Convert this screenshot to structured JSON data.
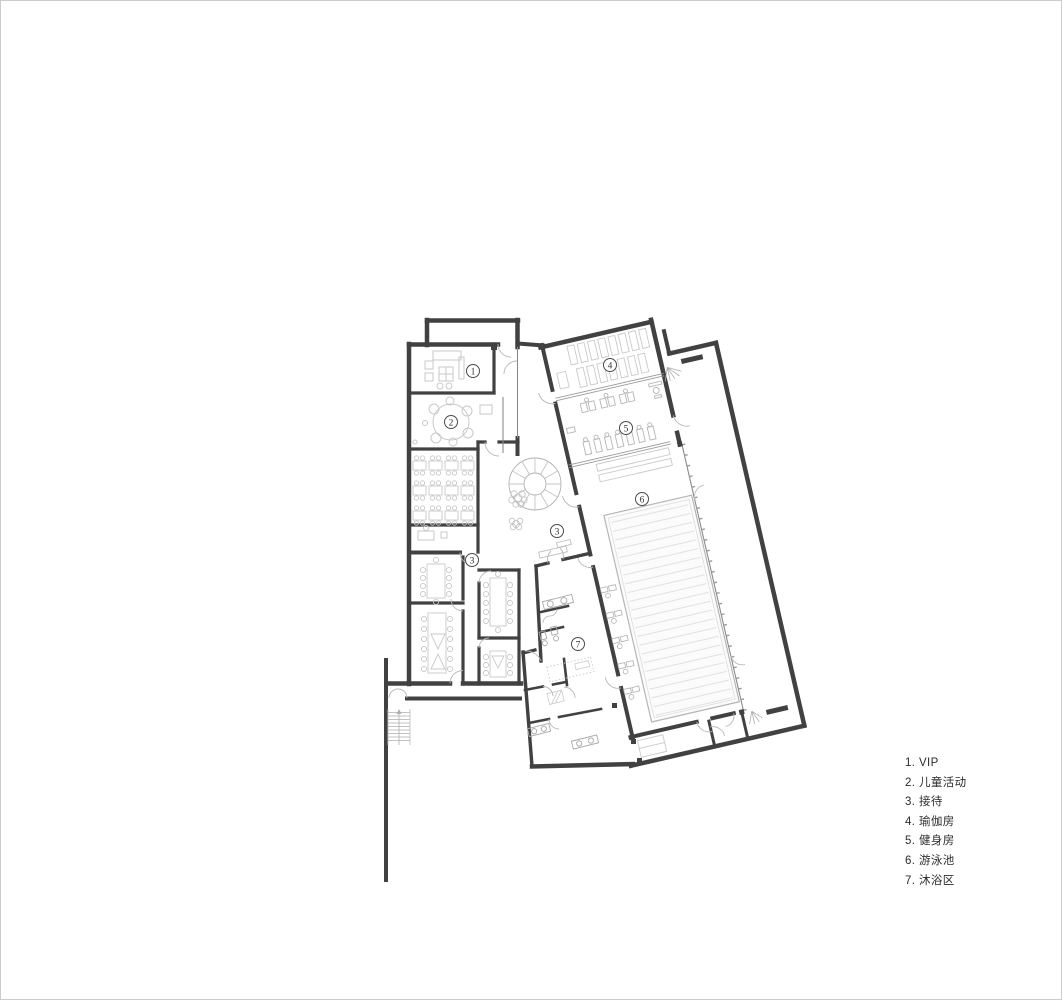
{
  "canvas": {
    "width": 1062,
    "height": 1000,
    "background": "#ffffff",
    "border_color": "#cccccc"
  },
  "colors": {
    "wall": "#414141",
    "furniture_light": "#c9c9c9",
    "furniture_mid": "#a8a8a8",
    "door_arc": "#b8b8b8",
    "glazing": "#8a8a8a",
    "pool_lane": "#e0e0e0",
    "marker_stroke": "#4a4a4a",
    "marker_text": "#333333",
    "legend_text": "#2b2b2b"
  },
  "legend": {
    "items": [
      {
        "number": "1.",
        "label": "VIP"
      },
      {
        "number": "2.",
        "label": "儿童活动"
      },
      {
        "number": "3.",
        "label": "接待"
      },
      {
        "number": "4.",
        "label": "瑜伽房"
      },
      {
        "number": "5.",
        "label": "健身房"
      },
      {
        "number": "6.",
        "label": "游泳池"
      },
      {
        "number": "7.",
        "label": "沐浴区"
      }
    ]
  },
  "floor_plan": {
    "room_markers": [
      {
        "number": "1",
        "x": 472,
        "y": 370
      },
      {
        "number": "2",
        "x": 450,
        "y": 421
      },
      {
        "number": "3",
        "x": 471,
        "y": 559
      },
      {
        "number": "3",
        "x": 556,
        "y": 530
      },
      {
        "number": "4",
        "x": 609,
        "y": 364
      },
      {
        "number": "5",
        "x": 625,
        "y": 427
      },
      {
        "number": "6",
        "x": 641,
        "y": 498
      },
      {
        "number": "7",
        "x": 577,
        "y": 643
      }
    ]
  }
}
